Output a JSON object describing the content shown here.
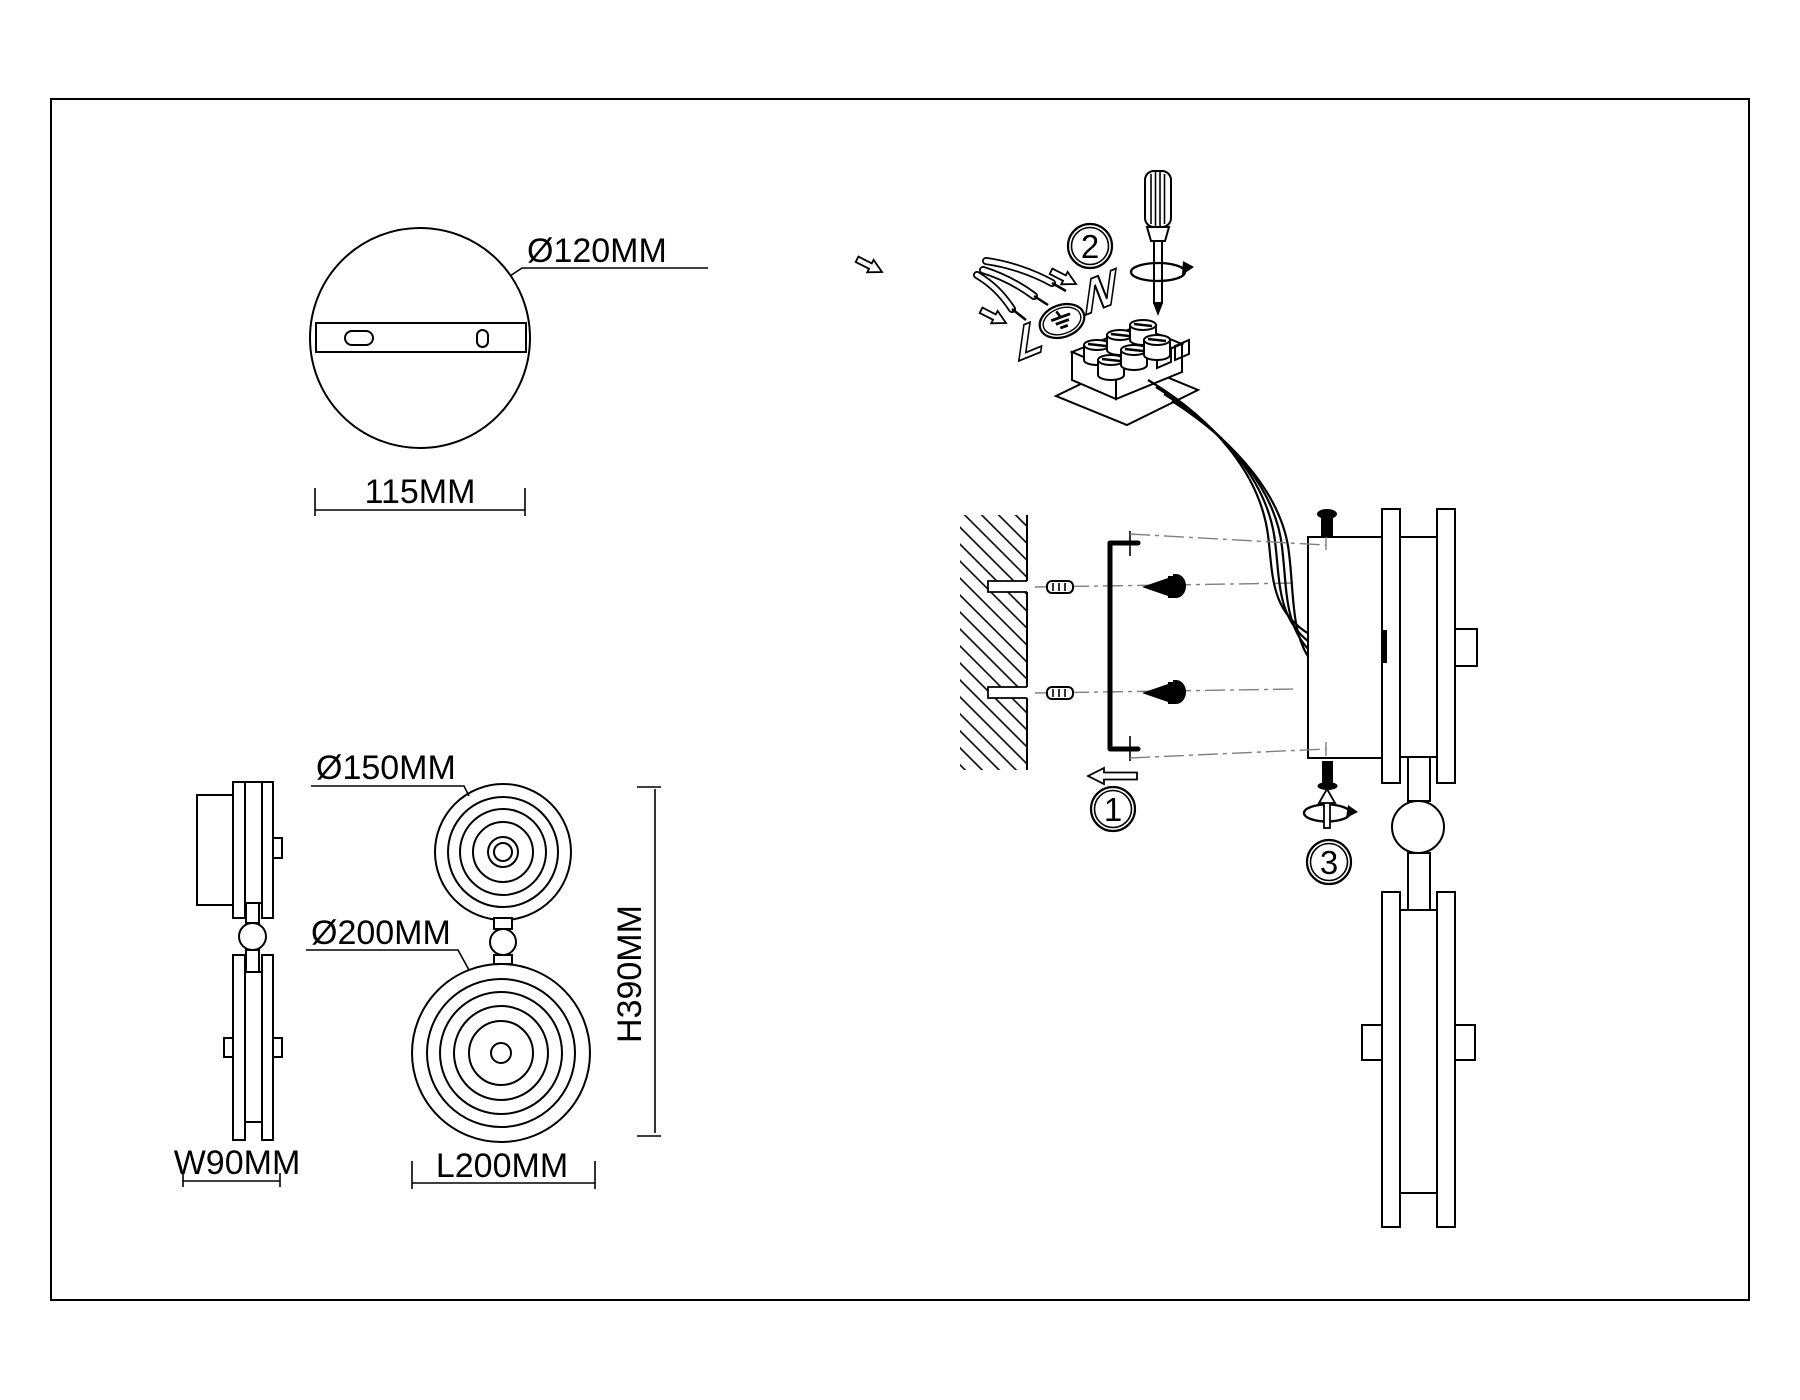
{
  "colors": {
    "line": "#000000",
    "centerline": "#7f7f7f",
    "background": "#ffffff"
  },
  "dimensions": {
    "canopy_diameter": "Ø120MM",
    "canopy_width": "115MM",
    "small_disc_diameter": "Ø150MM",
    "large_disc_diameter": "Ø200MM",
    "fixture_height": "H390MM",
    "fixture_length": "L200MM",
    "fixture_width": "W90MM"
  },
  "steps": {
    "one": "1",
    "two": "2",
    "three": "3"
  },
  "terminal": {
    "live": "L",
    "neutral": "N",
    "earth_icon": "earth-ground-symbol"
  }
}
